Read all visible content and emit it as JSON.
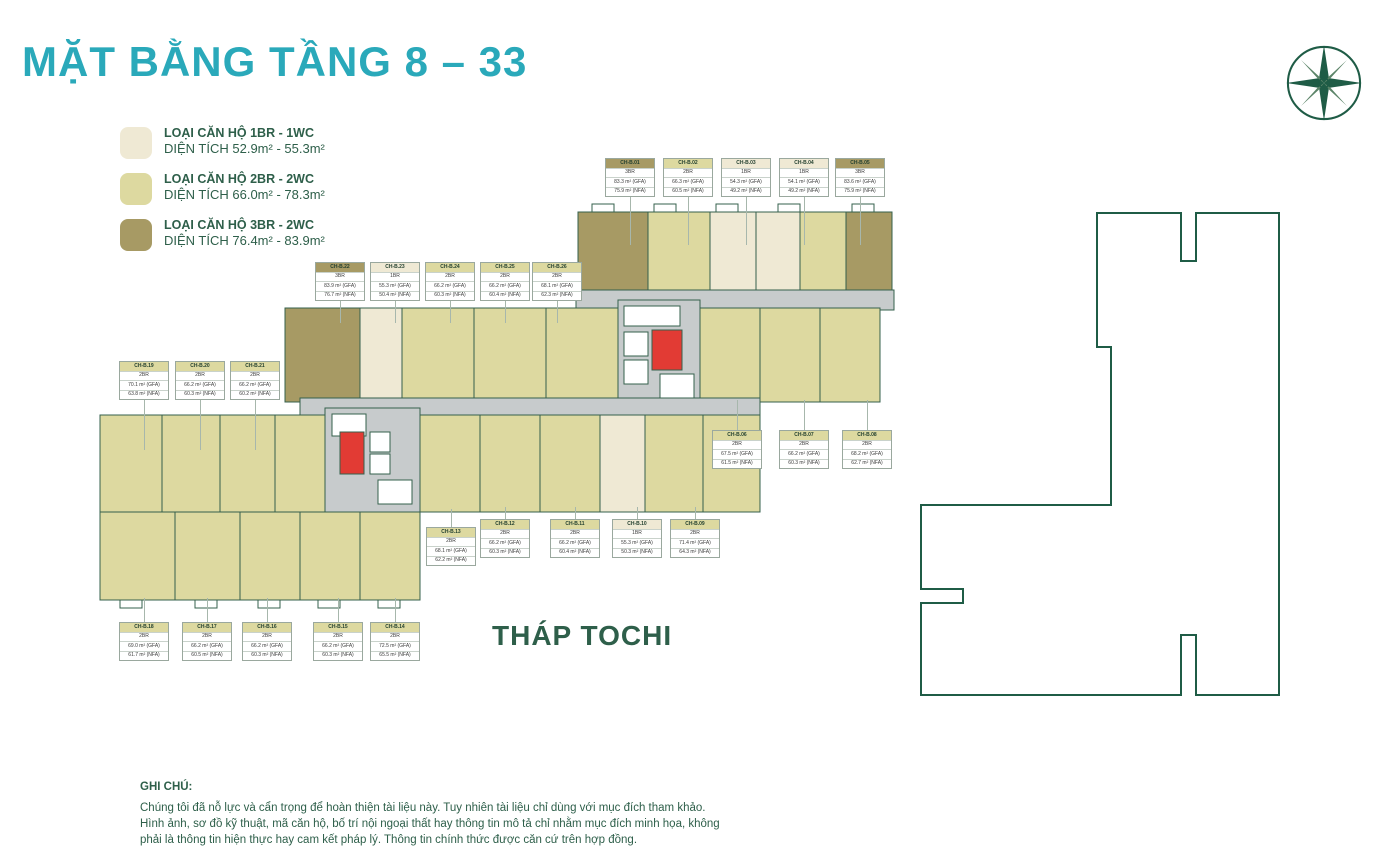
{
  "page": {
    "title": "MẶT BẰNG TẦNG 8 – 33",
    "tower_label": "THÁP TOCHI"
  },
  "colors": {
    "teal": "#2AA9BA",
    "green": "#1F5C46",
    "textgreen": "#2E5F4A",
    "line": "#35604C",
    "corridor": "#C7CBCC",
    "red": "#E23B34",
    "c1": "#EFE9D4",
    "c2": "#DDD9A0",
    "c3": "#A79A64"
  },
  "legend": {
    "items": [
      {
        "label": "LOẠI CĂN HỘ 1BR - 1WC",
        "area": "DIỆN TÍCH 52.9m² - 55.3m²",
        "color": "#EFE9D4"
      },
      {
        "label": "LOẠI CĂN HỘ 2BR - 2WC",
        "area": "DIỆN TÍCH 66.0m² - 78.3m²",
        "color": "#DDD9A0"
      },
      {
        "label": "LOẠI CĂN HỘ 3BR - 2WC",
        "area": "DIỆN TÍCH 76.4m² - 83.9m²",
        "color": "#A79A64"
      }
    ]
  },
  "notes": {
    "heading": "GHI CHÚ:",
    "body": "Chúng tôi đã nỗ lực và cẩn trọng để hoàn thiện tài liệu này. Tuy nhiên tài liệu chỉ dùng với mục đích tham khảo.\nHình ảnh, sơ đồ kỹ thuật, mã căn hộ, bố trí nội ngoại thất hay thông tin mô tả chỉ nhằm mục đích minh họa, không\nphải là thông tin hiện thực hay cam kết pháp lý. Thông tin chính thức được căn cứ trên hợp đồng."
  },
  "units": [
    {
      "id": "CH-B.01",
      "type": "3BR",
      "gfa": "83.3 m² (GFA)",
      "nfa": "75.9 m² (NFA)",
      "x": 630,
      "y": 158,
      "dir": "down",
      "len": 48
    },
    {
      "id": "CH-B.02",
      "type": "2BR",
      "gfa": "66.3 m² (GFA)",
      "nfa": "60.5 m² (NFA)",
      "x": 688,
      "y": 158,
      "dir": "down",
      "len": 48
    },
    {
      "id": "CH-B.03",
      "type": "1BR",
      "gfa": "54.3 m² (GFA)",
      "nfa": "49.2 m² (NFA)",
      "x": 746,
      "y": 158,
      "dir": "down",
      "len": 48
    },
    {
      "id": "CH-B.04",
      "type": "1BR",
      "gfa": "54.1 m² (GFA)",
      "nfa": "49.2 m² (NFA)",
      "x": 804,
      "y": 158,
      "dir": "down",
      "len": 48
    },
    {
      "id": "CH-B.05",
      "type": "3BR",
      "gfa": "83.6 m² (GFA)",
      "nfa": "75.9 m² (NFA)",
      "x": 860,
      "y": 158,
      "dir": "down",
      "len": 48
    },
    {
      "id": "CH-B.06",
      "type": "2BR",
      "gfa": "67.5 m² (GFA)",
      "nfa": "61.5 m² (NFA)",
      "x": 737,
      "y": 430,
      "dir": "up",
      "len": 30
    },
    {
      "id": "CH-B.07",
      "type": "2BR",
      "gfa": "66.2 m² (GFA)",
      "nfa": "60.3 m² (NFA)",
      "x": 804,
      "y": 430,
      "dir": "up",
      "len": 30
    },
    {
      "id": "CH-B.08",
      "type": "2BR",
      "gfa": "68.2 m² (GFA)",
      "nfa": "62.7 m² (NFA)",
      "x": 867,
      "y": 430,
      "dir": "up",
      "len": 30
    },
    {
      "id": "CH-B.09",
      "type": "2BR",
      "gfa": "71.4 m² (GFA)",
      "nfa": "64.3 m² (NFA)",
      "x": 695,
      "y": 519,
      "dir": "up",
      "len": 12
    },
    {
      "id": "CH-B.10",
      "type": "1BR",
      "gfa": "55.3 m² (GFA)",
      "nfa": "50.3 m² (NFA)",
      "x": 637,
      "y": 519,
      "dir": "up",
      "len": 12
    },
    {
      "id": "CH-B.11",
      "type": "2BR",
      "gfa": "66.2 m² (GFA)",
      "nfa": "60.4 m² (NFA)",
      "x": 575,
      "y": 519,
      "dir": "up",
      "len": 12
    },
    {
      "id": "CH-B.12",
      "type": "2BR",
      "gfa": "66.2 m² (GFA)",
      "nfa": "60.3 m² (NFA)",
      "x": 505,
      "y": 519,
      "dir": "up",
      "len": 12
    },
    {
      "id": "CH-B.13",
      "type": "2BR",
      "gfa": "68.1 m² (GFA)",
      "nfa": "62.2 m² (NFA)",
      "x": 451,
      "y": 527,
      "dir": "up",
      "len": 18
    },
    {
      "id": "CH-B.14",
      "type": "2BR",
      "gfa": "72.5 m² (GFA)",
      "nfa": "65.5 m² (NFA)",
      "x": 395,
      "y": 622,
      "dir": "up",
      "len": 24
    },
    {
      "id": "CH-B.15",
      "type": "2BR",
      "gfa": "66.2 m² (GFA)",
      "nfa": "60.3 m² (NFA)",
      "x": 338,
      "y": 622,
      "dir": "up",
      "len": 24
    },
    {
      "id": "CH-B.16",
      "type": "2BR",
      "gfa": "66.2 m² (GFA)",
      "nfa": "60.3 m² (NFA)",
      "x": 267,
      "y": 622,
      "dir": "up",
      "len": 24
    },
    {
      "id": "CH-B.17",
      "type": "2BR",
      "gfa": "66.2 m² (GFA)",
      "nfa": "60.5 m² (NFA)",
      "x": 207,
      "y": 622,
      "dir": "up",
      "len": 24
    },
    {
      "id": "CH-B.18",
      "type": "2BR",
      "gfa": "69.0 m² (GFA)",
      "nfa": "61.7 m² (NFA)",
      "x": 144,
      "y": 622,
      "dir": "up",
      "len": 24
    },
    {
      "id": "CH-B.19",
      "type": "2BR",
      "gfa": "70.1 m² (GFA)",
      "nfa": "63.8 m² (NFA)",
      "x": 144,
      "y": 361,
      "dir": "down",
      "len": 50
    },
    {
      "id": "CH-B.20",
      "type": "2BR",
      "gfa": "66.2 m² (GFA)",
      "nfa": "60.3 m² (NFA)",
      "x": 200,
      "y": 361,
      "dir": "down",
      "len": 50
    },
    {
      "id": "CH-B.21",
      "type": "2BR",
      "gfa": "66.2 m² (GFA)",
      "nfa": "60.2 m² (NFA)",
      "x": 255,
      "y": 361,
      "dir": "down",
      "len": 50
    },
    {
      "id": "CH-B.22",
      "type": "3BR",
      "gfa": "83.9 m² (GFA)",
      "nfa": "76.7 m² (NFA)",
      "x": 340,
      "y": 262,
      "dir": "down",
      "len": 22
    },
    {
      "id": "CH-B.23",
      "type": "1BR",
      "gfa": "55.3 m² (GFA)",
      "nfa": "50.4 m² (NFA)",
      "x": 395,
      "y": 262,
      "dir": "down",
      "len": 22
    },
    {
      "id": "CH-B.24",
      "type": "2BR",
      "gfa": "66.2 m² (GFA)",
      "nfa": "60.3 m² (NFA)",
      "x": 450,
      "y": 262,
      "dir": "down",
      "len": 22
    },
    {
      "id": "CH-B.25",
      "type": "2BR",
      "gfa": "66.2 m² (GFA)",
      "nfa": "60.4 m² (NFA)",
      "x": 505,
      "y": 262,
      "dir": "down",
      "len": 22
    },
    {
      "id": "CH-B.26",
      "type": "2BR",
      "gfa": "68.1 m² (GFA)",
      "nfa": "62.3 m² (NFA)",
      "x": 557,
      "y": 262,
      "dir": "down",
      "len": 22
    }
  ]
}
